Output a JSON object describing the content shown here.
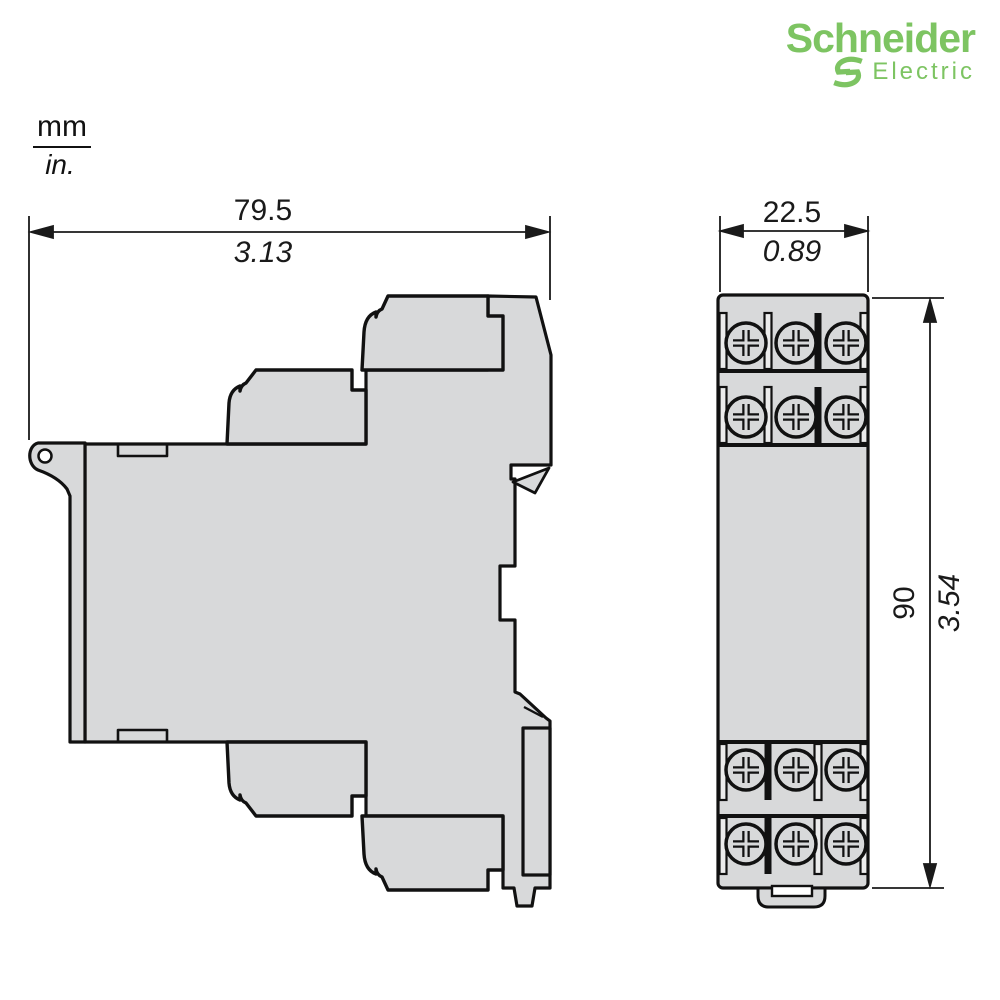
{
  "logo": {
    "brand": "Schneider",
    "sub_brand": "Electric",
    "color": "#7dc462"
  },
  "units_legend": {
    "numerator": "mm",
    "denominator": "in."
  },
  "drawing": {
    "description": "Dimensional outline drawing of DIN-rail relay module, side view and front view",
    "fill_color": "#d8d9da",
    "line_color": "#111111",
    "dimensions": {
      "side_width": {
        "mm": "79.5",
        "inches": "3.13"
      },
      "front_width": {
        "mm": "22.5",
        "inches": "0.89"
      },
      "height": {
        "mm": "90",
        "inches": "3.54"
      }
    },
    "front_view": {
      "terminal_rows": 4,
      "screws_per_row": 3
    }
  }
}
